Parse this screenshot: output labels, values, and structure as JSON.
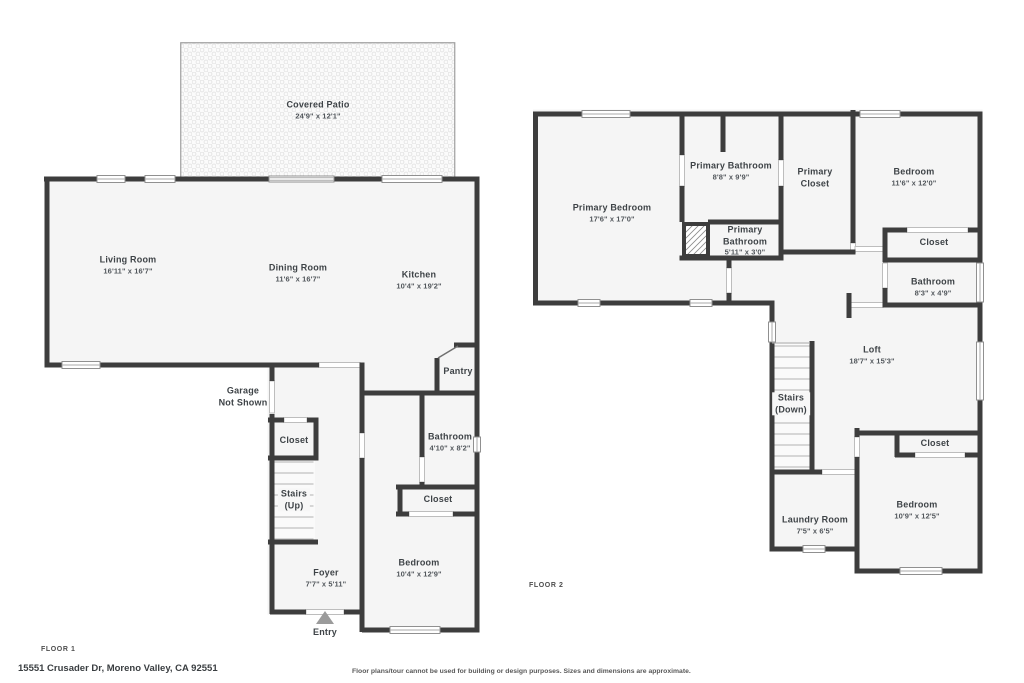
{
  "page": {
    "address": "15551 Crusader Dr, Moreno Valley, CA 92551",
    "disclaimer": "Floor plans/tour cannot be used for building or design purposes. Sizes and dimensions are approximate."
  },
  "colors": {
    "wall": "#3d3d3d",
    "room_fill": "#f5f5f5",
    "label_text": "#3e4347",
    "window_outline": "#909090",
    "stair_tread": "#c9c9c9",
    "entry_arrow": "#9b9b9b"
  },
  "floor1": {
    "tag": "FLOOR 1",
    "rooms": [
      {
        "id": "covered-patio",
        "label": "Covered Patio",
        "sub": "24'9\" x 12'1\""
      },
      {
        "id": "living-room",
        "label": "Living Room",
        "sub": "16'11\" x 16'7\""
      },
      {
        "id": "dining-room",
        "label": "Dining Room",
        "sub": "11'6\" x 16'7\""
      },
      {
        "id": "kitchen",
        "label": "Kitchen",
        "sub": "10'4\" x 19'2\""
      },
      {
        "id": "garage",
        "label": "Garage",
        "label2": "Not Shown"
      },
      {
        "id": "pantry",
        "label": "Pantry"
      },
      {
        "id": "hall-closet",
        "label": "Closet"
      },
      {
        "id": "stairs-up",
        "label": "Stairs",
        "label2": "(Up)"
      },
      {
        "id": "bathroom",
        "label": "Bathroom",
        "sub": "4'10\" x 8'2\""
      },
      {
        "id": "bedroom-closet",
        "label": "Closet"
      },
      {
        "id": "bedroom",
        "label": "Bedroom",
        "sub": "10'4\" x 12'9\""
      },
      {
        "id": "foyer",
        "label": "Foyer",
        "sub": "7'7\" x 5'11\""
      },
      {
        "id": "entry",
        "label": "Entry"
      }
    ]
  },
  "floor2": {
    "tag": "FLOOR 2",
    "rooms": [
      {
        "id": "primary-bedroom",
        "label": "Primary Bedroom",
        "sub": "17'6\" x 17'0\""
      },
      {
        "id": "primary-bathroom",
        "label": "Primary Bathroom",
        "sub": "8'8\" x 9'9\""
      },
      {
        "id": "primary-closet",
        "label": "Primary",
        "label2": "Closet"
      },
      {
        "id": "bedroom-upper",
        "label": "Bedroom",
        "sub": "11'6\" x 12'0\""
      },
      {
        "id": "primary-bathroom-2",
        "label": "Primary",
        "label2": "Bathroom",
        "sub": "5'11\" x 3'0\""
      },
      {
        "id": "closet-upper",
        "label": "Closet"
      },
      {
        "id": "bathroom",
        "label": "Bathroom",
        "sub": "8'3\" x 4'9\""
      },
      {
        "id": "loft",
        "label": "Loft",
        "sub": "18'7\" x 15'3\""
      },
      {
        "id": "stairs-down",
        "label": "Stairs",
        "label2": "(Down)"
      },
      {
        "id": "closet-lower",
        "label": "Closet"
      },
      {
        "id": "bedroom-lower",
        "label": "Bedroom",
        "sub": "10'9\" x 12'5\""
      },
      {
        "id": "laundry-room",
        "label": "Laundry Room",
        "sub": "7'5\" x 6'5\""
      }
    ]
  }
}
